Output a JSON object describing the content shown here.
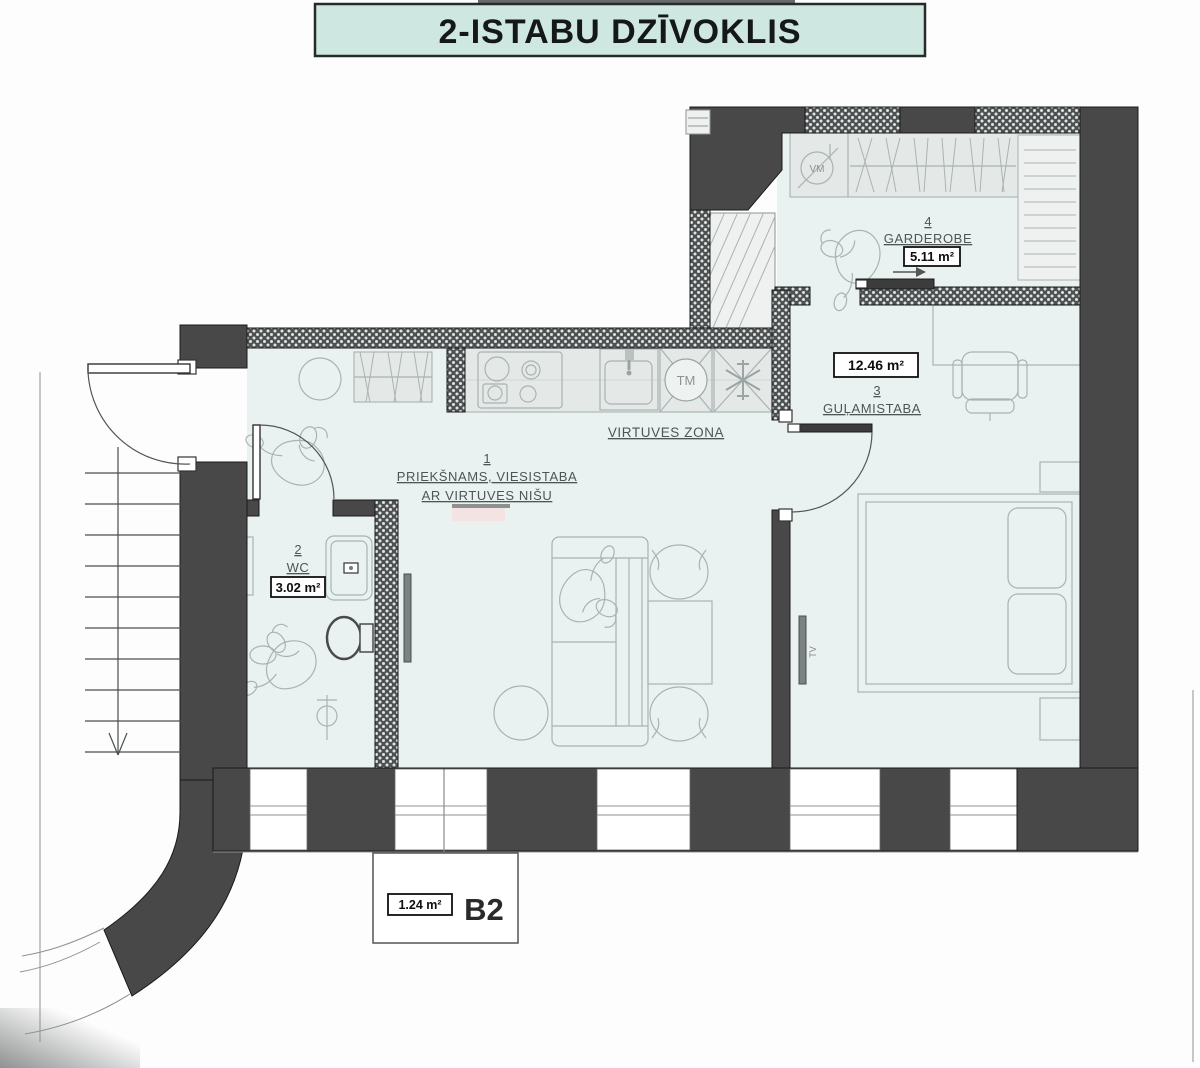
{
  "title": {
    "banner": "2-ISTABU DZĪVOKLIS"
  },
  "plan": {
    "unit": {
      "code": "B2",
      "area": "1.24 m²"
    },
    "rooms": [
      {
        "number": "1",
        "name": "PRIEKŠNAMS, VIESISTABA",
        "name2": "AR VIRTUVES NIŠU"
      },
      {
        "number": "2",
        "name": "WC",
        "area": "3.02 m²"
      },
      {
        "number": "3",
        "name": "GUĻAMISTABA",
        "area": "12.46 m²"
      },
      {
        "number": "4",
        "name": "GARDEROBE",
        "area": "5.11 m²"
      }
    ],
    "zones": {
      "kitchen": "VIRTUVES ZONA"
    },
    "appliances": {
      "dishwasher": "TM",
      "washing_machine": "VM",
      "tv": "TV"
    },
    "colors": {
      "wall": "#484848",
      "floor": "#e9f2f0",
      "banner_bg": "#cfe7e1",
      "furniture_line": "#a9b3b2",
      "hatch_base": "#4d5151"
    }
  }
}
